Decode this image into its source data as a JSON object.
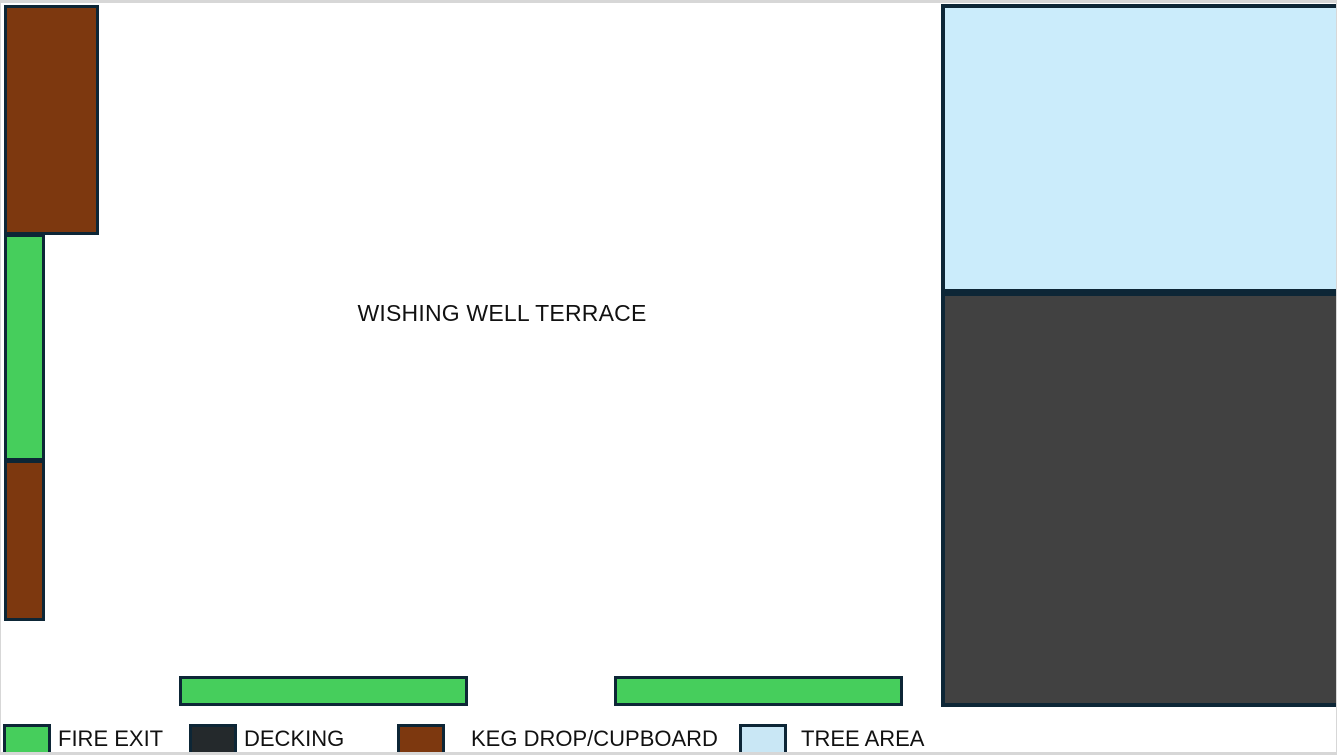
{
  "page": {
    "title": "WISHING WELL TERRACE"
  },
  "colors": {
    "fire_exit": "#46ce5c",
    "keg_drop": "#7d380f",
    "decking": "#414141",
    "decking_legend": "#24292c",
    "tree_area": "#cbecfb",
    "outline": "#0d2636",
    "page_edge": "#d7d7d7"
  },
  "legend": {
    "items": [
      {
        "label": "FIRE EXIT",
        "color": "#46ce5c"
      },
      {
        "label": "DECKING",
        "color": "#24292c"
      },
      {
        "label": "KEG DROP/CUPBOARD",
        "color": "#7d380f"
      },
      {
        "label": "TREE AREA",
        "color": "#c9e7f5"
      }
    ]
  },
  "zones": [
    {
      "name": "keg-drop-upper-left",
      "category": "KEG DROP/CUPBOARD"
    },
    {
      "name": "fire-exit-left",
      "category": "FIRE EXIT"
    },
    {
      "name": "keg-drop-lower-left",
      "category": "KEG DROP/CUPBOARD"
    },
    {
      "name": "tree-area-right",
      "category": "TREE AREA"
    },
    {
      "name": "decking-right",
      "category": "DECKING"
    },
    {
      "name": "fire-exit-bottom-left",
      "category": "FIRE EXIT"
    },
    {
      "name": "fire-exit-bottom-right",
      "category": "FIRE EXIT"
    }
  ]
}
